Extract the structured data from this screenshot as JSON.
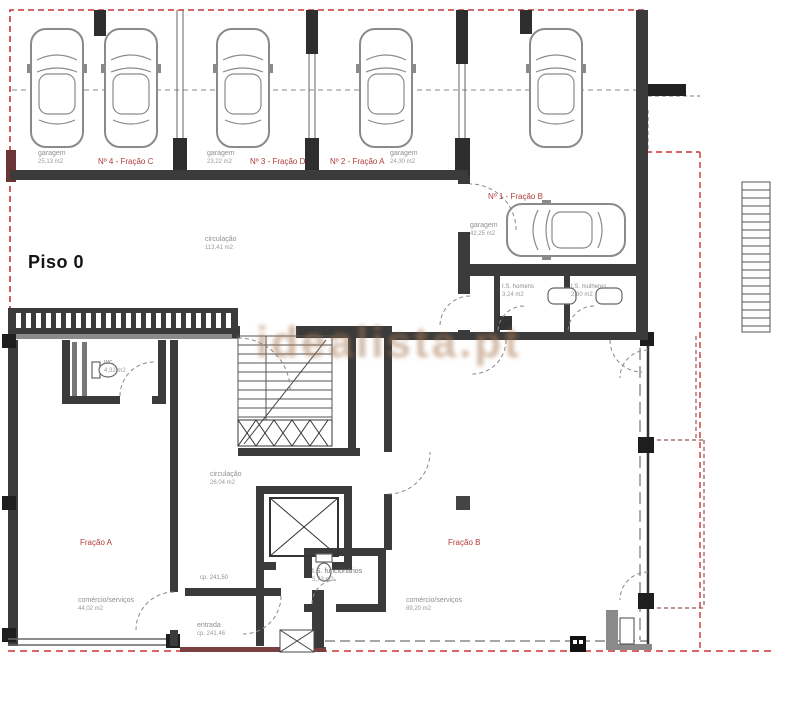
{
  "floor_label": "Piso 0",
  "watermark": "idealista.pt",
  "colors": {
    "boundary_red": "#cc3333",
    "fraction_red": "#b23b3b",
    "wall_dark": "#3b3b3b",
    "label_gray": "#8f8f8f",
    "watermark_tan": "#a87852"
  },
  "garages": [
    {
      "name": "garagem",
      "area": "25,13 m2",
      "fraction": "Nº 4 - Fração C"
    },
    {
      "name": "garagem",
      "area": "23,22 m2",
      "fraction": "Nº 3 - Fração D"
    },
    {
      "name": "garagem",
      "area": "24,30 m2",
      "fraction": "Nº 2 - Fração A"
    },
    {
      "name": "garagem",
      "area": "42,25 m2",
      "fraction": "Nº 1 - Fração B"
    }
  ],
  "rooms": [
    {
      "name": "circulação",
      "area": "113,41 m2"
    },
    {
      "name": "I.S. homens",
      "area": "3,24 m2"
    },
    {
      "name": "I.S. mulheres",
      "area": "2,60 m2"
    },
    {
      "name": "wc",
      "area": "4,32 m2"
    },
    {
      "name": "circulação",
      "area": "26,04 m2"
    },
    {
      "name": "I.S. funcionários",
      "area": "5,73 m2"
    },
    {
      "name": "entrada",
      "area": "cp. 241,46"
    },
    {
      "name": "comércio/serviços",
      "area": "44,02 m2"
    },
    {
      "name": "comércio/serviços",
      "area": "89,20 m2"
    }
  ],
  "fractions": [
    {
      "label": "Fração A"
    },
    {
      "label": "Fração B"
    }
  ],
  "annotations": [
    {
      "label": "cp. 241,50"
    }
  ]
}
